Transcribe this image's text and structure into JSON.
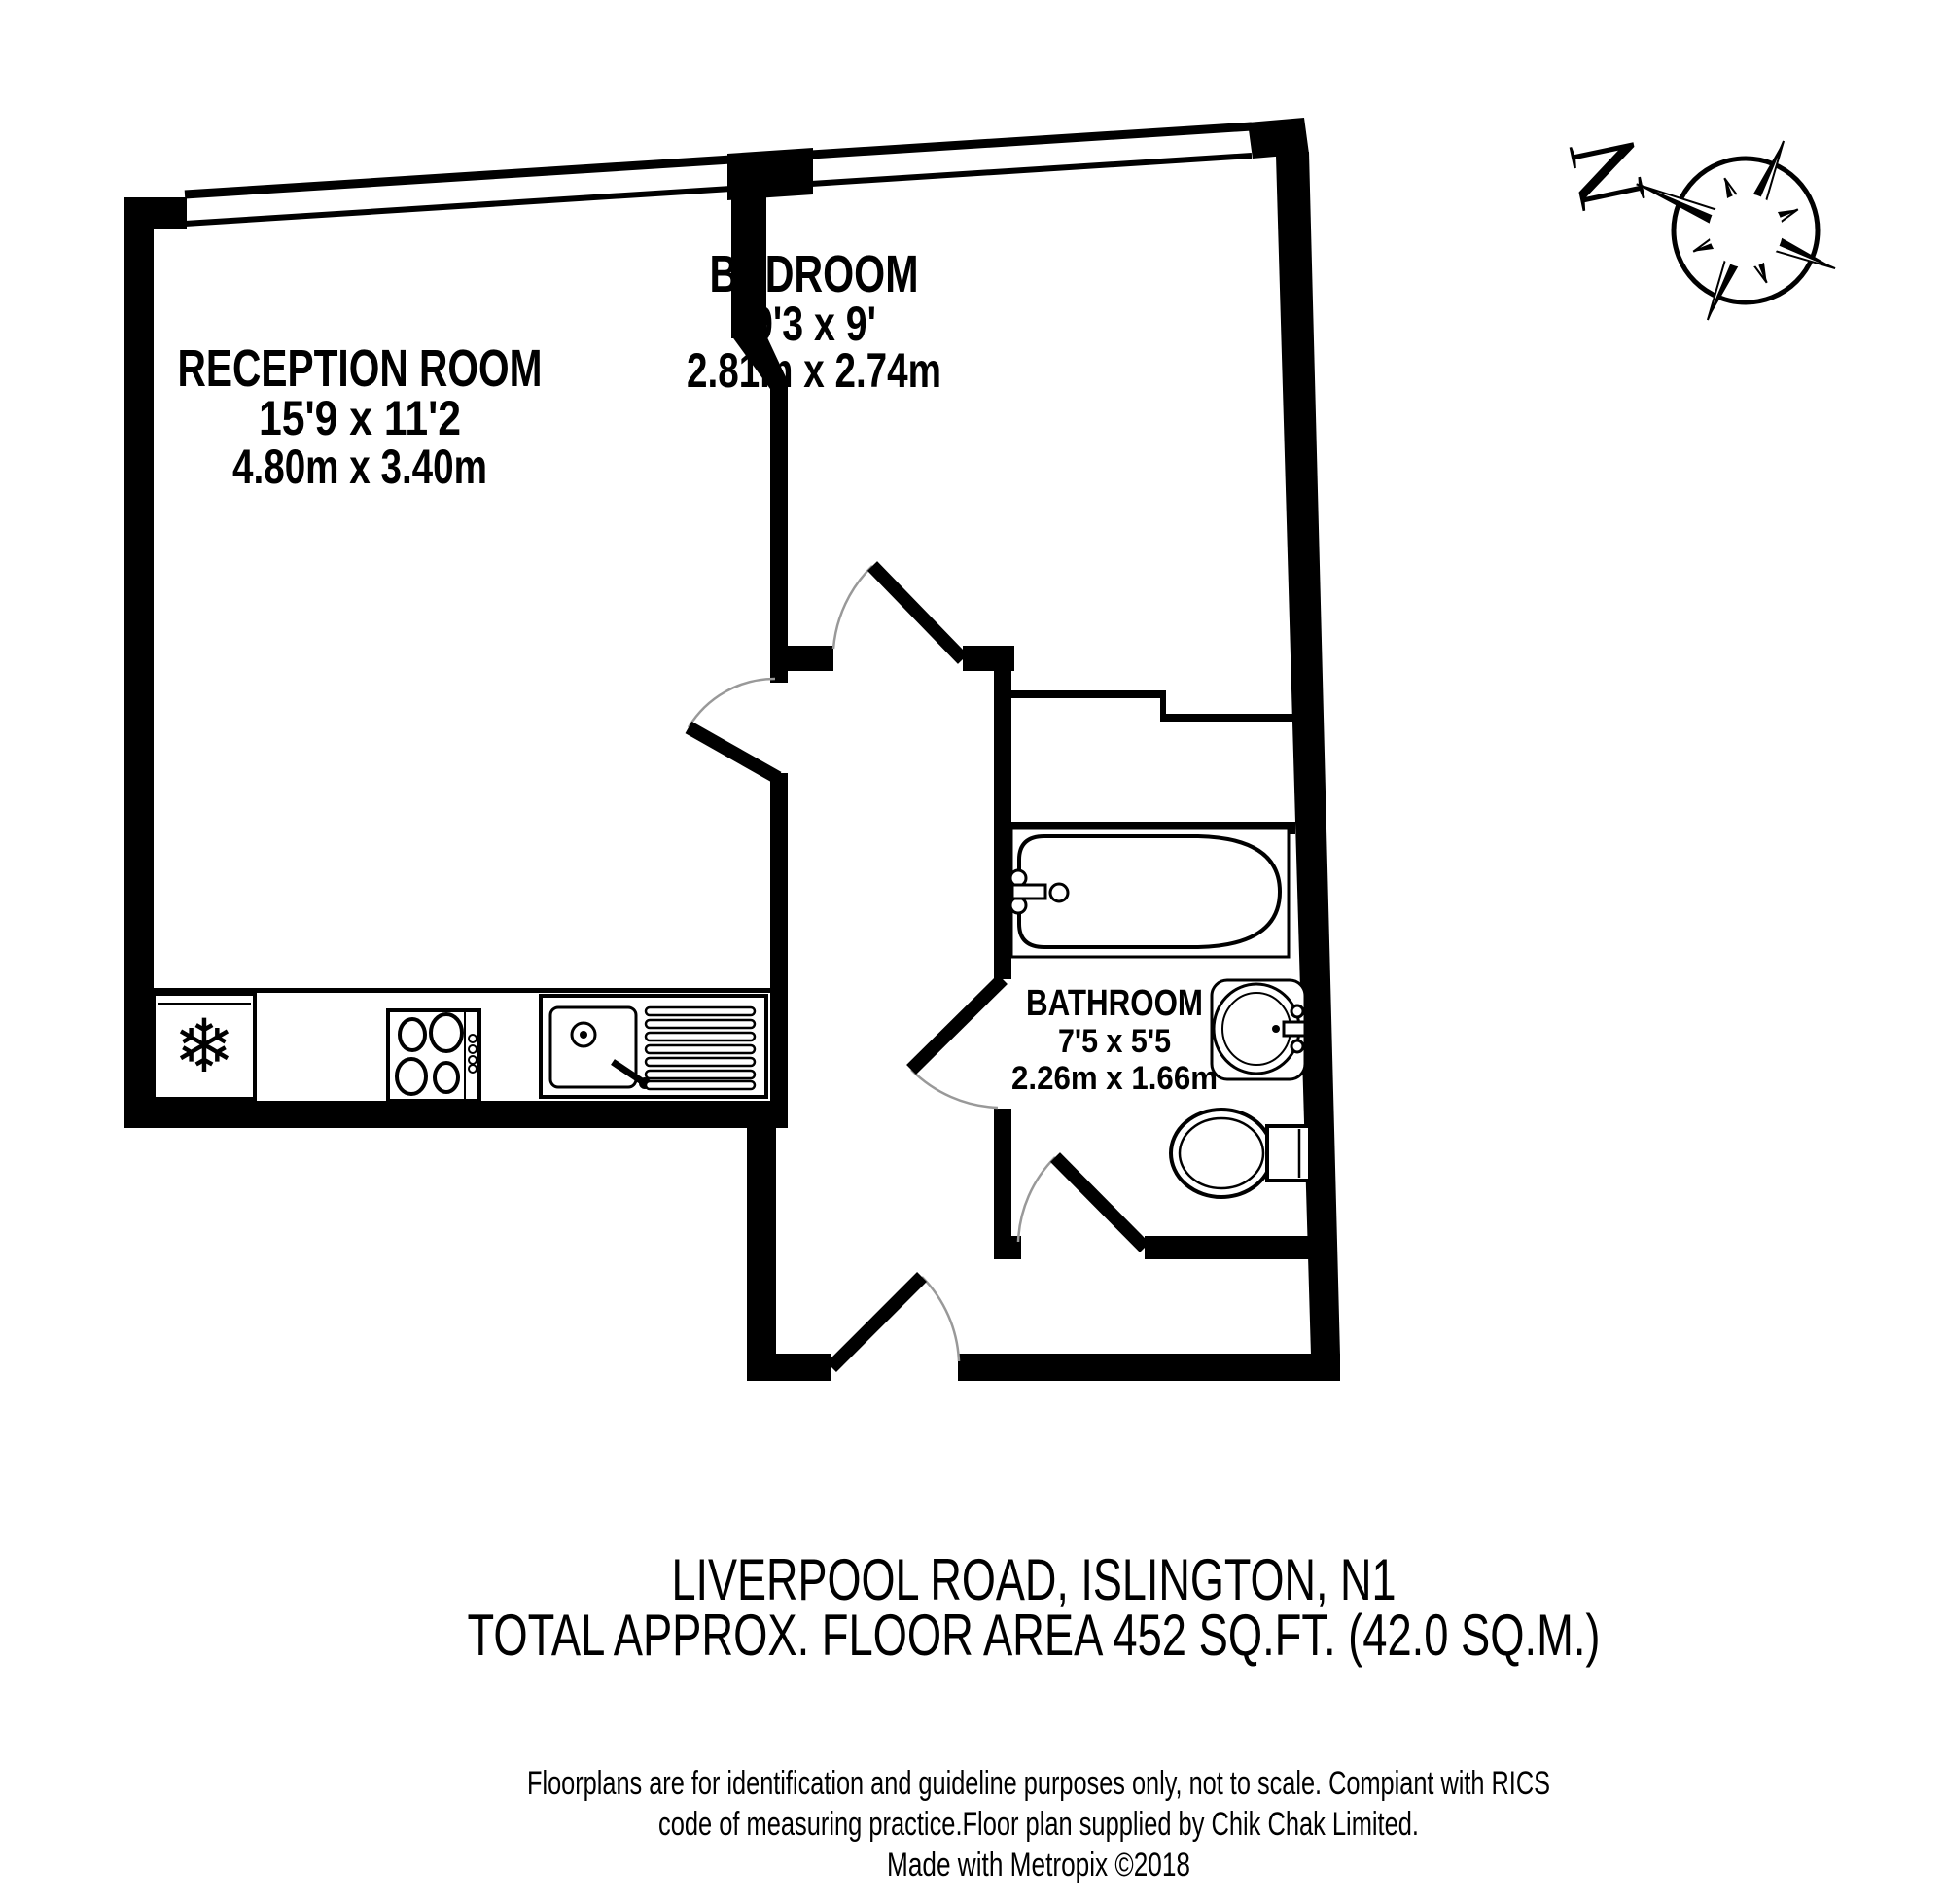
{
  "rooms": {
    "reception": {
      "name": "RECEPTION ROOM",
      "imperial": "15'9 x 11'2",
      "metric": "4.80m x 3.40m"
    },
    "bedroom": {
      "name": "BEDROOM",
      "imperial": "9'3 x 9'",
      "metric": "2.81m x 2.74m"
    },
    "bathroom": {
      "name": "BATHROOM",
      "imperial": "7'5 x 5'5",
      "metric": "2.26m x 1.66m"
    }
  },
  "compass": {
    "north": "N"
  },
  "icons": {
    "freezer": "❄"
  },
  "footer": {
    "address": "LIVERPOOL ROAD, ISLINGTON, N1",
    "area": "TOTAL APPROX. FLOOR AREA 452 SQ.FT. (42.0 SQ.M.)"
  },
  "disclaimer": {
    "line1": "Floorplans are for identification and guideline purposes only, not to scale. Compiant with RICS",
    "line2": "code of measuring practice.Floor plan supplied by Chik Chak Limited.",
    "line3": "Made with Metropix ©2018"
  },
  "colors": {
    "wall": "#000000",
    "background": "#ffffff",
    "door_arc": "#999999"
  }
}
